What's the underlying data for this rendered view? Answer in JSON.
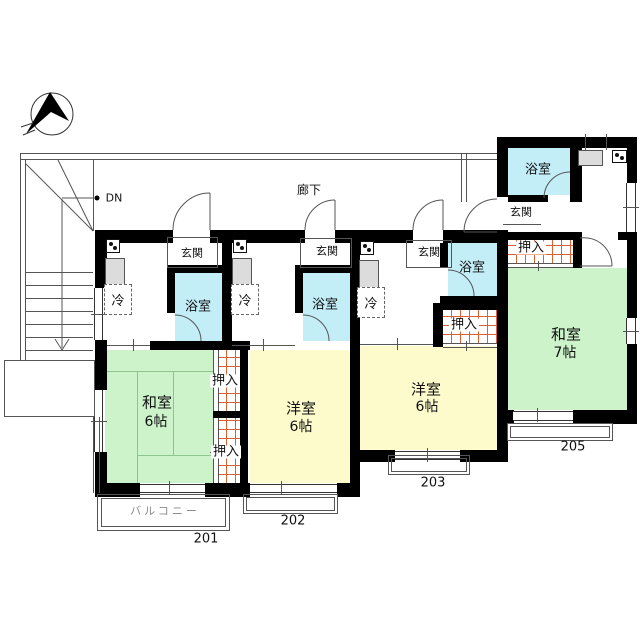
{
  "colors": {
    "wall": "#000000",
    "tatami_room": "#cdf3ca",
    "western_room": "#fdfbcc",
    "bath": "#c3eef8",
    "closet_hatch": "#d96233",
    "sink": "#dcdcdc",
    "balcony_text": "#8a8a8a"
  },
  "common": {
    "corridor": "廊下",
    "stairs_down": "DN"
  },
  "units": {
    "u201": {
      "number": "201",
      "entrance": "玄関",
      "bath": "浴室",
      "fridge": "冷",
      "room_type": "和室",
      "room_size": "6帖",
      "closet_upper": "押入",
      "closet_lower": "押入",
      "balcony": "バルコニー"
    },
    "u202": {
      "number": "202",
      "entrance": "玄関",
      "bath": "浴室",
      "fridge": "冷",
      "room_type": "洋室",
      "room_size": "6帖"
    },
    "u203": {
      "number": "203",
      "entrance": "玄関",
      "bath": "浴室",
      "fridge": "冷",
      "room_type": "洋室",
      "room_size": "6帖",
      "closet": "押入"
    },
    "u205": {
      "number": "205",
      "entrance": "玄関",
      "bath": "浴室",
      "room_type": "和室",
      "room_size": "7帖",
      "closet": "押入"
    }
  }
}
